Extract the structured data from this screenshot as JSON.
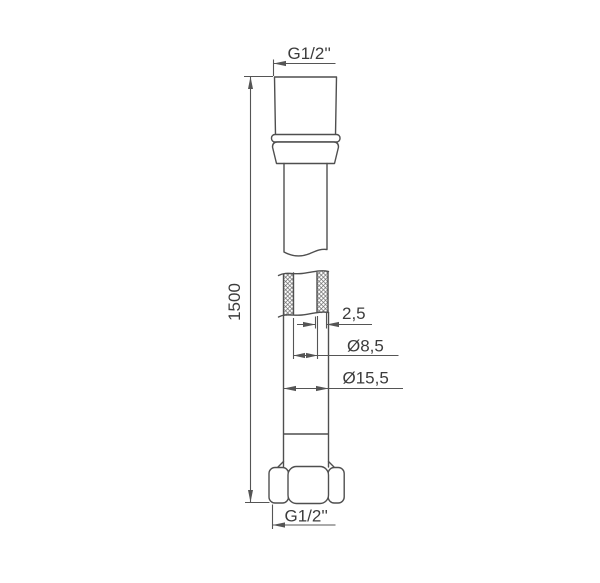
{
  "drawing": {
    "title": "shower-hose-technical-drawing",
    "labels": {
      "top_thread": "G1/2''",
      "length": "1500",
      "wall_thickness": "2,5",
      "inner_diameter": "Ø8,5",
      "outer_diameter": "Ø15,5",
      "bottom_thread": "G1/2''"
    },
    "colors": {
      "line": "#4f4f4f",
      "dim": "#555555",
      "text": "#3c3c3c",
      "background": "#ffffff",
      "hatch": "#6a6a6a"
    }
  }
}
